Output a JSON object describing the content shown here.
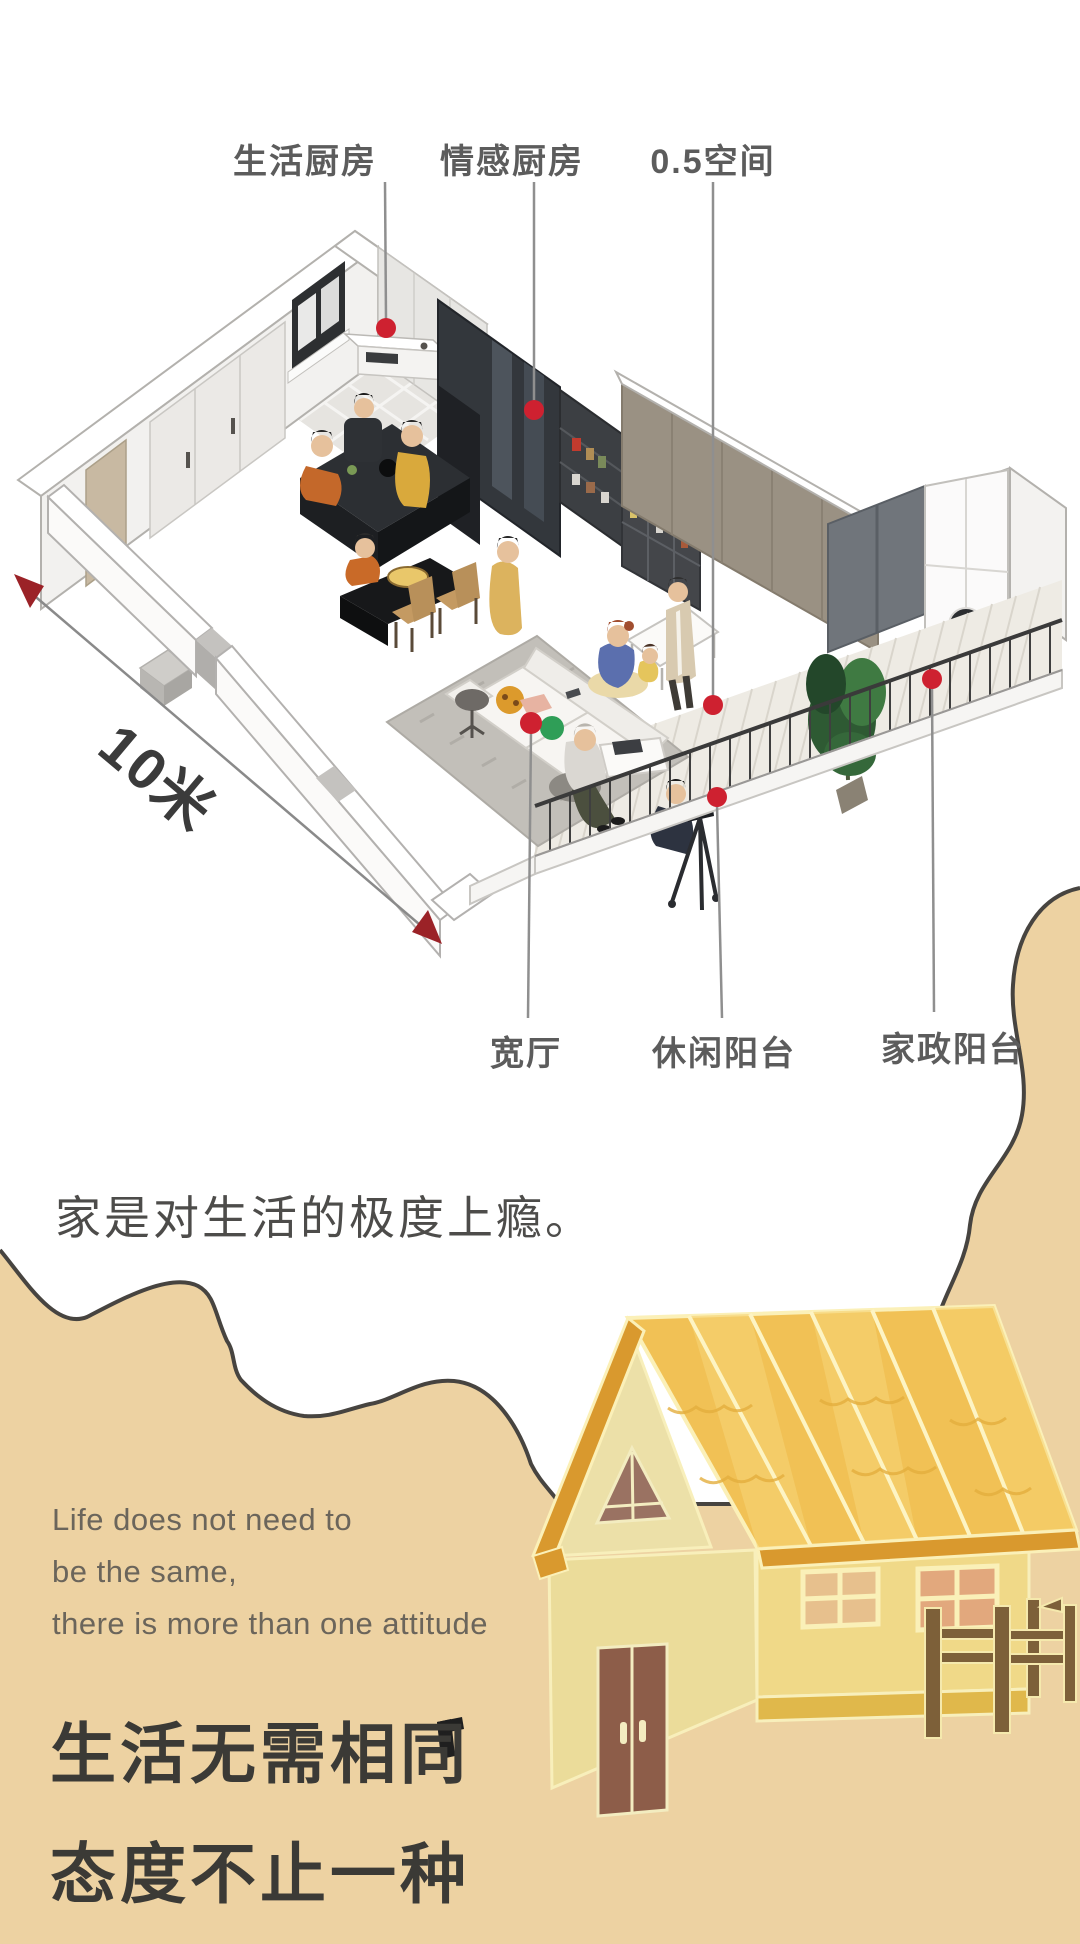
{
  "floor_plan": {
    "labels_top": [
      {
        "text": "生活厨房"
      },
      {
        "text": "情感厨房"
      },
      {
        "text": "0.5空间"
      }
    ],
    "labels_bottom": [
      {
        "text": "宽厅"
      },
      {
        "text": "休闲阳台"
      },
      {
        "text": "家政阳台"
      }
    ],
    "dimension_text": "10米",
    "dot_color": "#ce2130",
    "arrow_color": "#9b2227",
    "leader_line_color": "#8f8f8f"
  },
  "slogan": "家是对生活的极度上瘾。",
  "tagline_en": {
    "line1": "Life does not need to",
    "line2": "be the same,",
    "line3": "there is more than one attitude"
  },
  "title": {
    "line1": "生活无需相同",
    "line2": "态度不止一种"
  },
  "colors": {
    "tan_background": "#edd2a2",
    "blob_outline": "#474440",
    "roof_gold": "#f1c155",
    "wall_yellow": "#f0d988",
    "door_brown": "#8d5d49",
    "fence_brown": "#7d6039"
  }
}
